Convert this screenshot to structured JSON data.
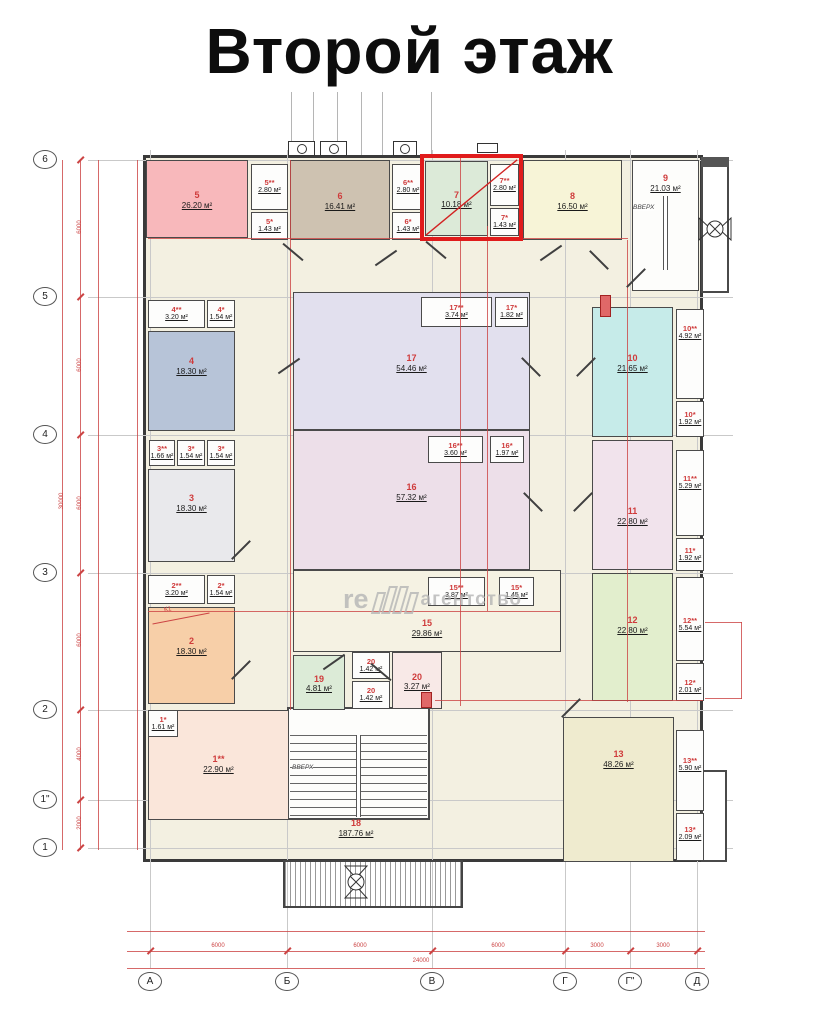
{
  "title": "Второй этаж",
  "watermark": {
    "part1": "re",
    "part2": "агентство"
  },
  "annotations": {
    "k1": "К1"
  },
  "stairs": {
    "up": "ВВЕРХ"
  },
  "highlight": {
    "color": "#e01b1b",
    "rooms": [
      "7",
      "7**",
      "7*"
    ]
  },
  "axes": {
    "vertical": [
      {
        "label": "6",
        "y": 160
      },
      {
        "label": "5",
        "y": 297
      },
      {
        "label": "4",
        "y": 435
      },
      {
        "label": "3",
        "y": 573
      },
      {
        "label": "2",
        "y": 710
      },
      {
        "label": "1\"",
        "y": 800
      },
      {
        "label": "1",
        "y": 848
      }
    ],
    "horizontal": [
      {
        "label": "А",
        "x": 150
      },
      {
        "label": "Б",
        "x": 287
      },
      {
        "label": "В",
        "x": 432
      },
      {
        "label": "Г",
        "x": 565
      },
      {
        "label": "Г\"",
        "x": 630
      },
      {
        "label": "Д",
        "x": 697
      }
    ]
  },
  "dimensions": {
    "bottom": [
      {
        "x": 218,
        "label": "6000"
      },
      {
        "x": 360,
        "label": "6000"
      },
      {
        "x": 498,
        "label": "6000"
      },
      {
        "x": 597,
        "label": "3000"
      },
      {
        "x": 663,
        "label": "3000"
      }
    ],
    "bottom_total": "24000",
    "left": [
      {
        "y": 228,
        "label": "6000"
      },
      {
        "y": 366,
        "label": "6000"
      },
      {
        "y": 504,
        "label": "6000"
      },
      {
        "y": 641,
        "label": "6000"
      },
      {
        "y": 755,
        "label": "4000"
      },
      {
        "y": 824,
        "label": "2000"
      }
    ],
    "left_total": "30000"
  },
  "rooms": [
    {
      "id": "5",
      "num": "5",
      "area": "26.20 м²",
      "color": "#f8b8bb",
      "rect": [
        146,
        160,
        102,
        78
      ]
    },
    {
      "id": "5ss",
      "num": "5**",
      "area": "2.80 м²",
      "color": "#fdfdfc",
      "rect": [
        251,
        164,
        37,
        46
      ],
      "small": true
    },
    {
      "id": "5s",
      "num": "5*",
      "area": "1.43 м²",
      "color": "#fdfdfc",
      "rect": [
        251,
        212,
        37,
        28
      ],
      "small": true
    },
    {
      "id": "6",
      "num": "6",
      "area": "16.41 м²",
      "color": "#cec2b1",
      "rect": [
        290,
        160,
        100,
        80
      ]
    },
    {
      "id": "6ss",
      "num": "6**",
      "area": "2.80 м²",
      "color": "#fdfdfc",
      "rect": [
        392,
        164,
        32,
        46
      ],
      "small": true
    },
    {
      "id": "6s",
      "num": "6*",
      "area": "1.43 м²",
      "color": "#fdfdfc",
      "rect": [
        392,
        212,
        32,
        28
      ],
      "small": true
    },
    {
      "id": "7",
      "num": "7",
      "area": "10.18 м²",
      "color": "#dcead8",
      "rect": [
        425,
        161,
        63,
        75
      ]
    },
    {
      "id": "7ss",
      "num": "7**",
      "area": "2.80 м²",
      "color": "#fdfdfc",
      "rect": [
        490,
        164,
        29,
        42
      ],
      "small": true
    },
    {
      "id": "7s",
      "num": "7*",
      "area": "1.43 м²",
      "color": "#fdfdfc",
      "rect": [
        490,
        208,
        29,
        28
      ],
      "small": true
    },
    {
      "id": "8",
      "num": "8",
      "area": "16.50 м²",
      "color": "#f7f4d7",
      "rect": [
        523,
        160,
        99,
        80
      ]
    },
    {
      "id": "9",
      "num": "9",
      "area": "21.03 м²",
      "color": "#fdfdfb",
      "rect": [
        632,
        160,
        67,
        131
      ],
      "ly": 182
    },
    {
      "id": "4ss",
      "num": "4**",
      "area": "3.20 м²",
      "color": "#fdfdfc",
      "rect": [
        148,
        300,
        57,
        28
      ],
      "small": true
    },
    {
      "id": "4s",
      "num": "4*",
      "area": "1.54 м²",
      "color": "#fdfdfc",
      "rect": [
        207,
        300,
        28,
        28
      ],
      "small": true
    },
    {
      "id": "4",
      "num": "4",
      "area": "18.30 м²",
      "color": "#b7c4d8",
      "rect": [
        148,
        331,
        87,
        100
      ],
      "ly": 365
    },
    {
      "id": "3ss",
      "num": "3**",
      "area": "1.66 м²",
      "color": "#fdfdfc",
      "rect": [
        149,
        440,
        26,
        26
      ],
      "small": true
    },
    {
      "id": "3sa",
      "num": "3*",
      "area": "1.54 м²",
      "color": "#fdfdfc",
      "rect": [
        177,
        440,
        28,
        26
      ],
      "small": true
    },
    {
      "id": "3sb",
      "num": "3*",
      "area": "1.54 м²",
      "color": "#fdfdfc",
      "rect": [
        207,
        440,
        28,
        26
      ],
      "small": true
    },
    {
      "id": "3",
      "num": "3",
      "area": "18.30 м²",
      "color": "#e9e9ec",
      "rect": [
        148,
        469,
        87,
        93
      ],
      "ly": 502
    },
    {
      "id": "2ss",
      "num": "2**",
      "area": "3.20 м²",
      "color": "#fdfdfc",
      "rect": [
        148,
        575,
        57,
        29
      ],
      "small": true
    },
    {
      "id": "2s",
      "num": "2*",
      "area": "1.54 м²",
      "color": "#fdfdfc",
      "rect": [
        207,
        575,
        28,
        29
      ],
      "small": true
    },
    {
      "id": "2",
      "num": "2",
      "area": "18.30 м²",
      "color": "#f7cfa8",
      "rect": [
        148,
        607,
        87,
        97
      ],
      "ly": 645
    },
    {
      "id": "1ss",
      "num": "1**",
      "area": "22.90 м²",
      "color": "#fae6da",
      "rect": [
        148,
        710,
        141,
        110
      ],
      "ly": 763
    },
    {
      "id": "1s",
      "num": "1*",
      "area": "1.61 м²",
      "color": "#fdfdfc",
      "rect": [
        148,
        710,
        30,
        27
      ],
      "small": true
    },
    {
      "id": "17",
      "num": "17",
      "area": "54.46 м²",
      "color": "#e2e0ee",
      "rect": [
        293,
        292,
        237,
        138
      ],
      "ly": 362
    },
    {
      "id": "17ss",
      "num": "17**",
      "area": "3.74 м²",
      "color": "#fdfdfc",
      "rect": [
        421,
        297,
        71,
        30
      ],
      "small": true
    },
    {
      "id": "17s",
      "num": "17*",
      "area": "1.82 м²",
      "color": "#fdfdfc",
      "rect": [
        495,
        297,
        33,
        30
      ],
      "small": true
    },
    {
      "id": "16",
      "num": "16",
      "area": "57.32 м²",
      "color": "#eddfe9",
      "rect": [
        293,
        430,
        237,
        140
      ],
      "ly": 491
    },
    {
      "id": "16ss",
      "num": "16**",
      "area": "3.60 м²",
      "color": "#fdfdfc",
      "rect": [
        428,
        436,
        55,
        27
      ],
      "small": true
    },
    {
      "id": "16s",
      "num": "16*",
      "area": "1.97 м²",
      "color": "#fdfdfc",
      "rect": [
        490,
        436,
        34,
        27
      ],
      "small": true
    },
    {
      "id": "15",
      "num": "15",
      "area": "29.86 м²",
      "color": "#f5f2e3",
      "rect": [
        293,
        570,
        268,
        82
      ],
      "ly": 627
    },
    {
      "id": "15ss",
      "num": "15**",
      "area": "3.87 м²",
      "color": "#fdfdfc",
      "rect": [
        428,
        577,
        57,
        29
      ],
      "small": true
    },
    {
      "id": "15s",
      "num": "15*",
      "area": "1.45 м²",
      "color": "#fdfdfc",
      "rect": [
        499,
        577,
        35,
        29
      ],
      "small": true
    },
    {
      "id": "19",
      "num": "19",
      "area": "4.81 м²",
      "color": "#dcebd7",
      "rect": [
        293,
        655,
        52,
        55
      ]
    },
    {
      "id": "20a",
      "num": "20",
      "area": "1.42 м²",
      "color": "#fdfdfc",
      "rect": [
        352,
        652,
        38,
        27
      ],
      "small": true
    },
    {
      "id": "20b",
      "num": "20",
      "area": "1.42 м²",
      "color": "#fdfdfc",
      "rect": [
        352,
        681,
        38,
        28
      ],
      "small": true
    },
    {
      "id": "20",
      "num": "20",
      "area": "3.27 м²",
      "color": "#f8e9e7",
      "rect": [
        392,
        652,
        50,
        57
      ]
    },
    {
      "id": "10",
      "num": "10",
      "area": "21.65 м²",
      "color": "#c6ebe9",
      "rect": [
        592,
        307,
        81,
        130
      ],
      "ly": 362
    },
    {
      "id": "10ss",
      "num": "10**",
      "area": "4.92 м²",
      "color": "#fdfdfc",
      "rect": [
        676,
        309,
        28,
        90
      ],
      "small": true,
      "ly": 333
    },
    {
      "id": "10s",
      "num": "10*",
      "area": "1.92 м²",
      "color": "#fdfdfc",
      "rect": [
        676,
        401,
        28,
        36
      ],
      "small": true
    },
    {
      "id": "11",
      "num": "11",
      "area": "22.80 м²",
      "color": "#f1e3ec",
      "rect": [
        592,
        440,
        81,
        130
      ],
      "ly": 515
    },
    {
      "id": "11ss",
      "num": "11**",
      "area": "5.29 м²",
      "color": "#fdfdfc",
      "rect": [
        676,
        450,
        28,
        86
      ],
      "small": true,
      "ly": 483
    },
    {
      "id": "11s",
      "num": "11*",
      "area": "1.92 м²",
      "color": "#fdfdfc",
      "rect": [
        676,
        538,
        28,
        33
      ],
      "small": true
    },
    {
      "id": "12",
      "num": "12",
      "area": "22.80 м²",
      "color": "#e2eecd",
      "rect": [
        592,
        573,
        81,
        128
      ],
      "ly": 624
    },
    {
      "id": "12ss",
      "num": "12**",
      "area": "5.54 м²",
      "color": "#fdfdfc",
      "rect": [
        676,
        577,
        28,
        84
      ],
      "small": true,
      "ly": 625
    },
    {
      "id": "12s",
      "num": "12*",
      "area": "2.01 м²",
      "color": "#fdfdfc",
      "rect": [
        676,
        663,
        28,
        38
      ],
      "small": true,
      "ly": 687
    },
    {
      "id": "13",
      "num": "13",
      "area": "48.26 м²",
      "color": "#efebcf",
      "rect": [
        563,
        717,
        111,
        145
      ],
      "ly": 758
    },
    {
      "id": "13ss",
      "num": "13**",
      "area": "5.90 м²",
      "color": "#fdfdfc",
      "rect": [
        676,
        730,
        28,
        81
      ],
      "small": true,
      "ly": 765
    },
    {
      "id": "13s",
      "num": "13*",
      "area": "2.09 м²",
      "color": "#fdfdfc",
      "rect": [
        676,
        813,
        28,
        48
      ],
      "small": true,
      "ly": 834
    },
    {
      "id": "18",
      "num": "18",
      "area": "187.76 м²",
      "color": "",
      "rect": [
        300,
        810,
        112,
        42
      ],
      "plain": true,
      "ly": 828
    }
  ]
}
